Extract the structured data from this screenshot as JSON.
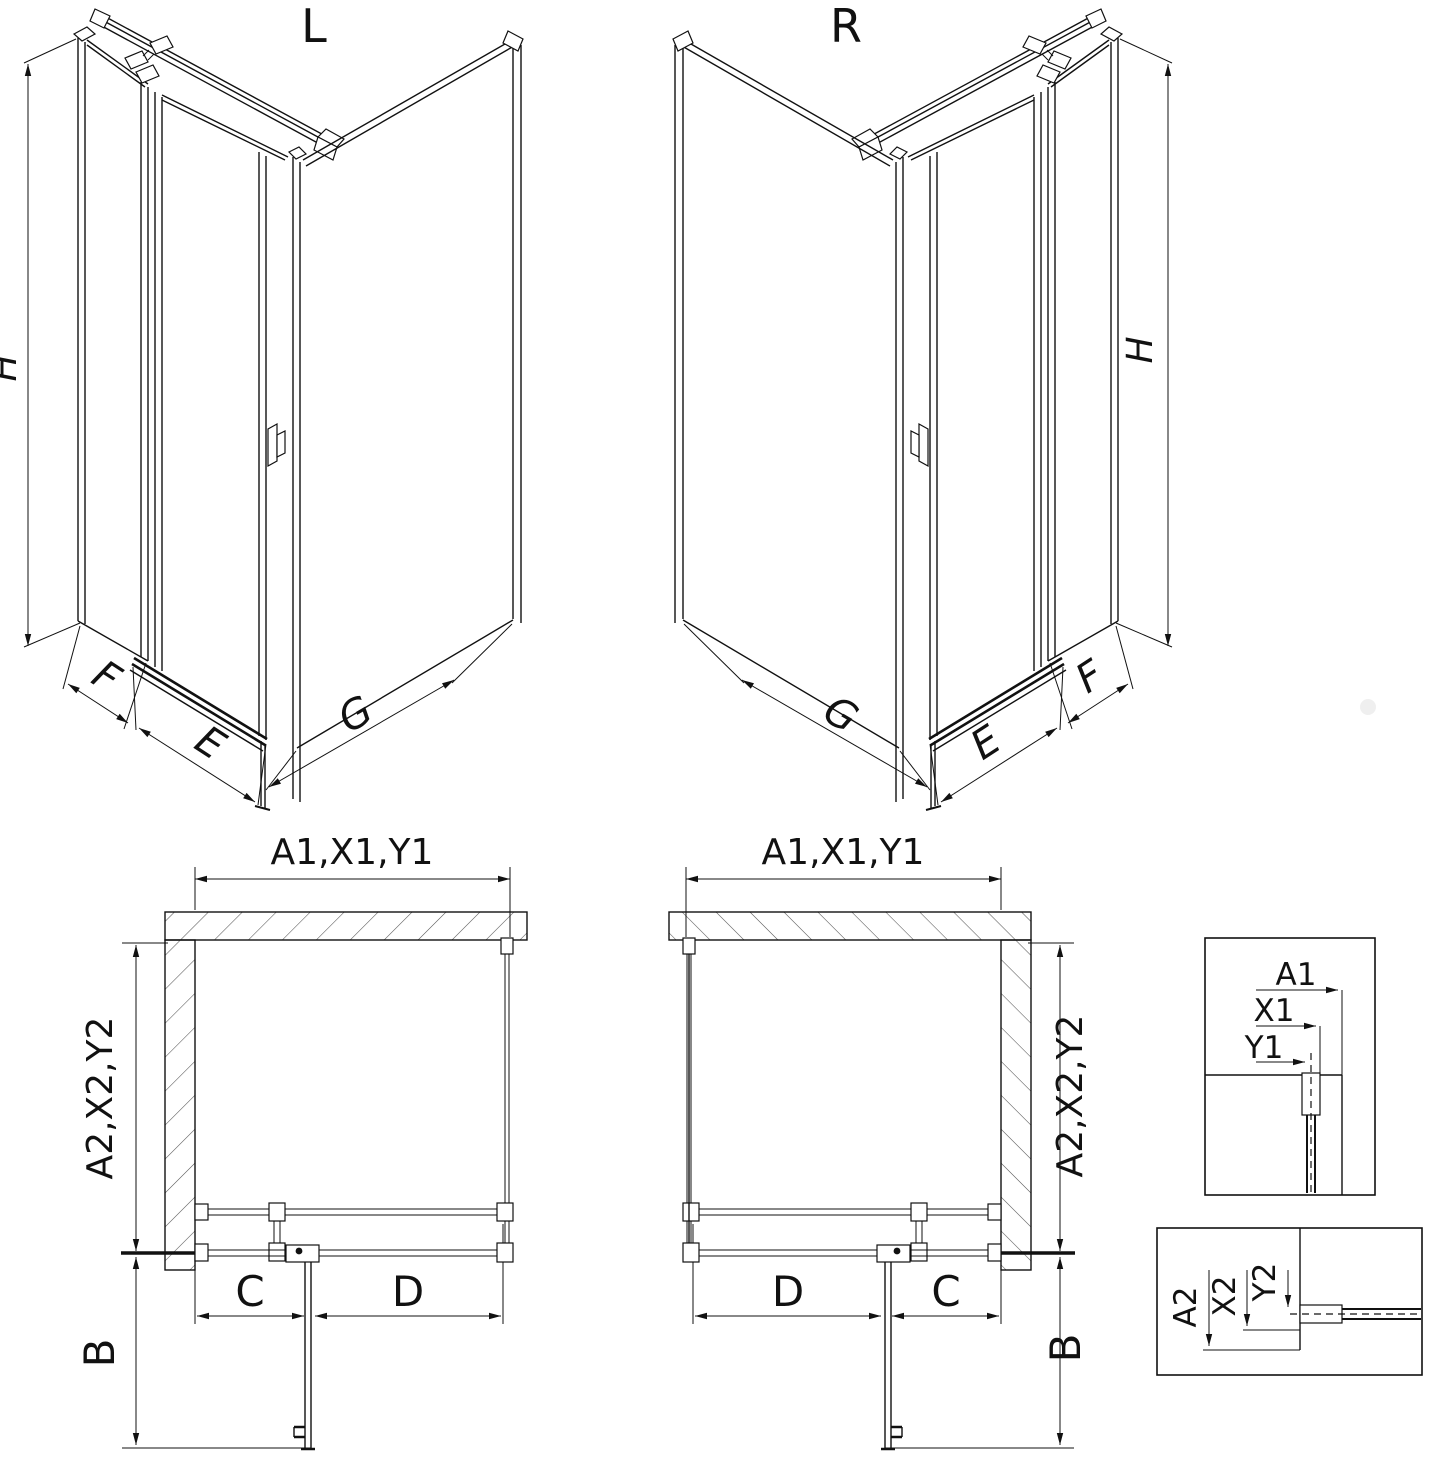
{
  "drawing": {
    "variant_left": {
      "title": "L",
      "dim_height": "H",
      "dim_side_panel": "F",
      "dim_front": "E",
      "dim_return_panel": "G"
    },
    "variant_right": {
      "title": "R",
      "dim_height": "H",
      "dim_side_panel": "F",
      "dim_front": "E",
      "dim_return_panel": "G"
    },
    "plan_left": {
      "dim_top": "A1,X1,Y1",
      "dim_side": "A2,X2,Y2",
      "dim_fixed": "C",
      "dim_door": "D",
      "dim_door_open": "B"
    },
    "plan_right": {
      "dim_top": "A1,X1,Y1",
      "dim_side": "A2,X2,Y2",
      "dim_fixed": "C",
      "dim_door": "D",
      "dim_door_open": "B"
    },
    "detail_wall_top": {
      "dim_a": "A1",
      "dim_x": "X1",
      "dim_y": "Y1"
    },
    "detail_wall_side": {
      "dim_a": "A2",
      "dim_x": "X2",
      "dim_y": "Y2"
    },
    "colors": {
      "line": "#111111",
      "hatch": "#555555",
      "background": "#ffffff"
    }
  }
}
